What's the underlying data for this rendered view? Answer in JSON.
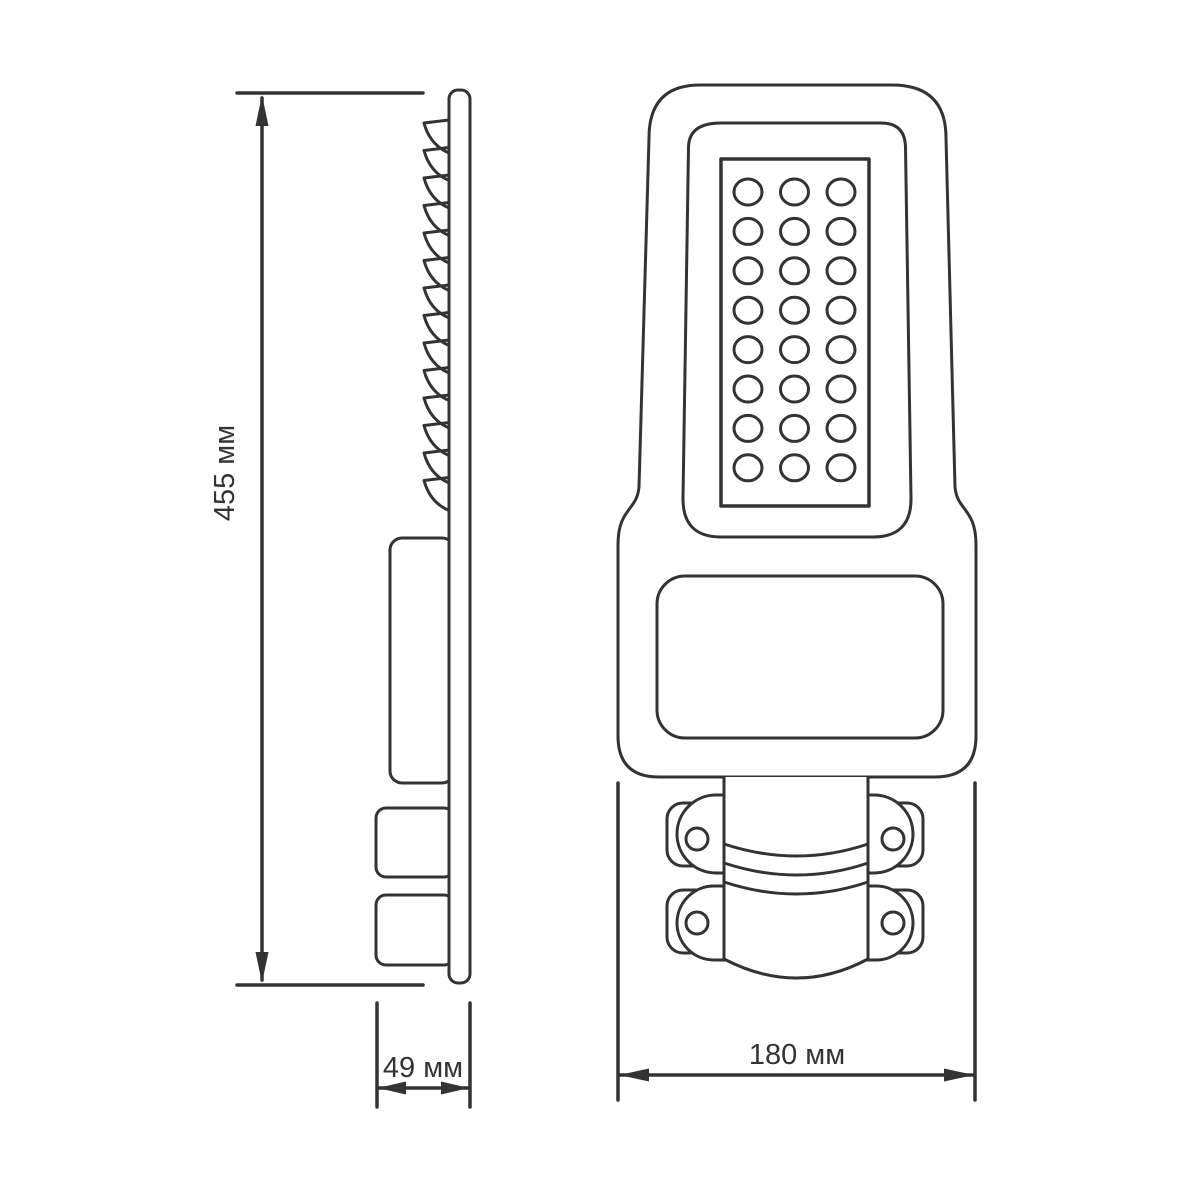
{
  "drawing": {
    "kind": "technical dimension drawing, LED street light, two orthographic views"
  },
  "side_view": {
    "height_dimension": {
      "label": "455 мм",
      "value": 455,
      "unit": "мм"
    },
    "depth_dimension": {
      "label": "49 мм",
      "value": 49,
      "unit": "мм"
    },
    "heatsink_fins": {
      "count": 14
    }
  },
  "front_view": {
    "width_dimension": {
      "label": "180 мм",
      "value": 180,
      "unit": "мм"
    },
    "led_grid": {
      "rows": 8,
      "columns": 3,
      "total_leds": 24
    },
    "mount_screw_holes": 4,
    "clamp_bands": 3
  },
  "style": {
    "line_color": "#333333",
    "background_color": "#ffffff",
    "dimension_text_color": "#333333"
  }
}
